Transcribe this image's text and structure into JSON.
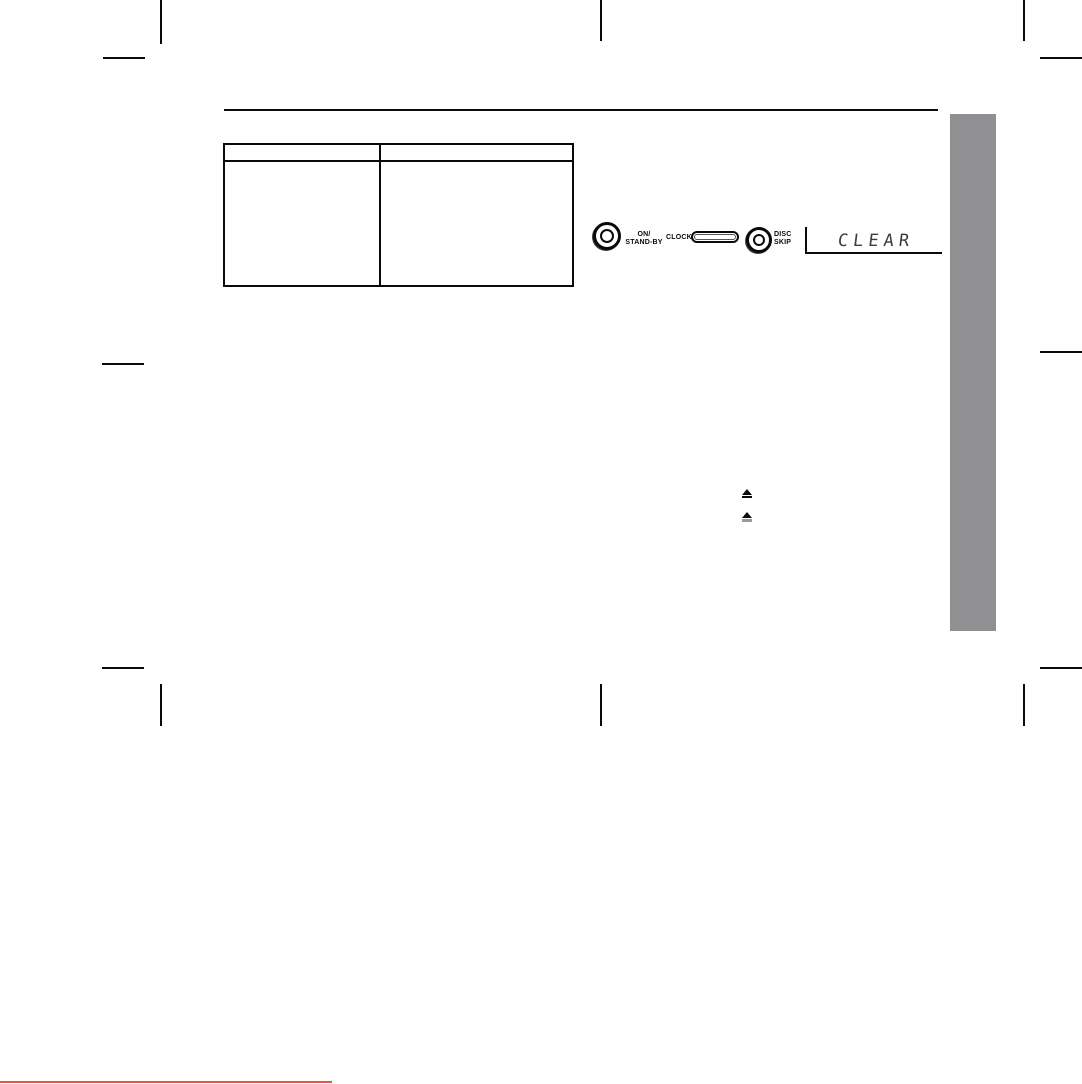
{
  "document": {
    "kind": "scanned manual page proof",
    "background": "#ffffff"
  },
  "colors": {
    "ink": "#0a0a0a",
    "sidebar_gray": "#909092",
    "footer_accent_red": "#e4544b",
    "display_ink": "#3d3d3d"
  },
  "reference_table": {
    "header": [
      "",
      ""
    ],
    "rows": [
      [
        "",
        ""
      ]
    ]
  },
  "control_panel": {
    "power_button": {
      "label_line1": "ON/",
      "label_line2": "STAND-BY"
    },
    "clock_button": {
      "label": "CLOCK"
    },
    "disc_skip_button": {
      "label_line1": "DISC",
      "label_line2": "SKIP"
    },
    "display": {
      "text": "CLEAR"
    }
  },
  "icons": {
    "eject_symbol": "⏏"
  }
}
